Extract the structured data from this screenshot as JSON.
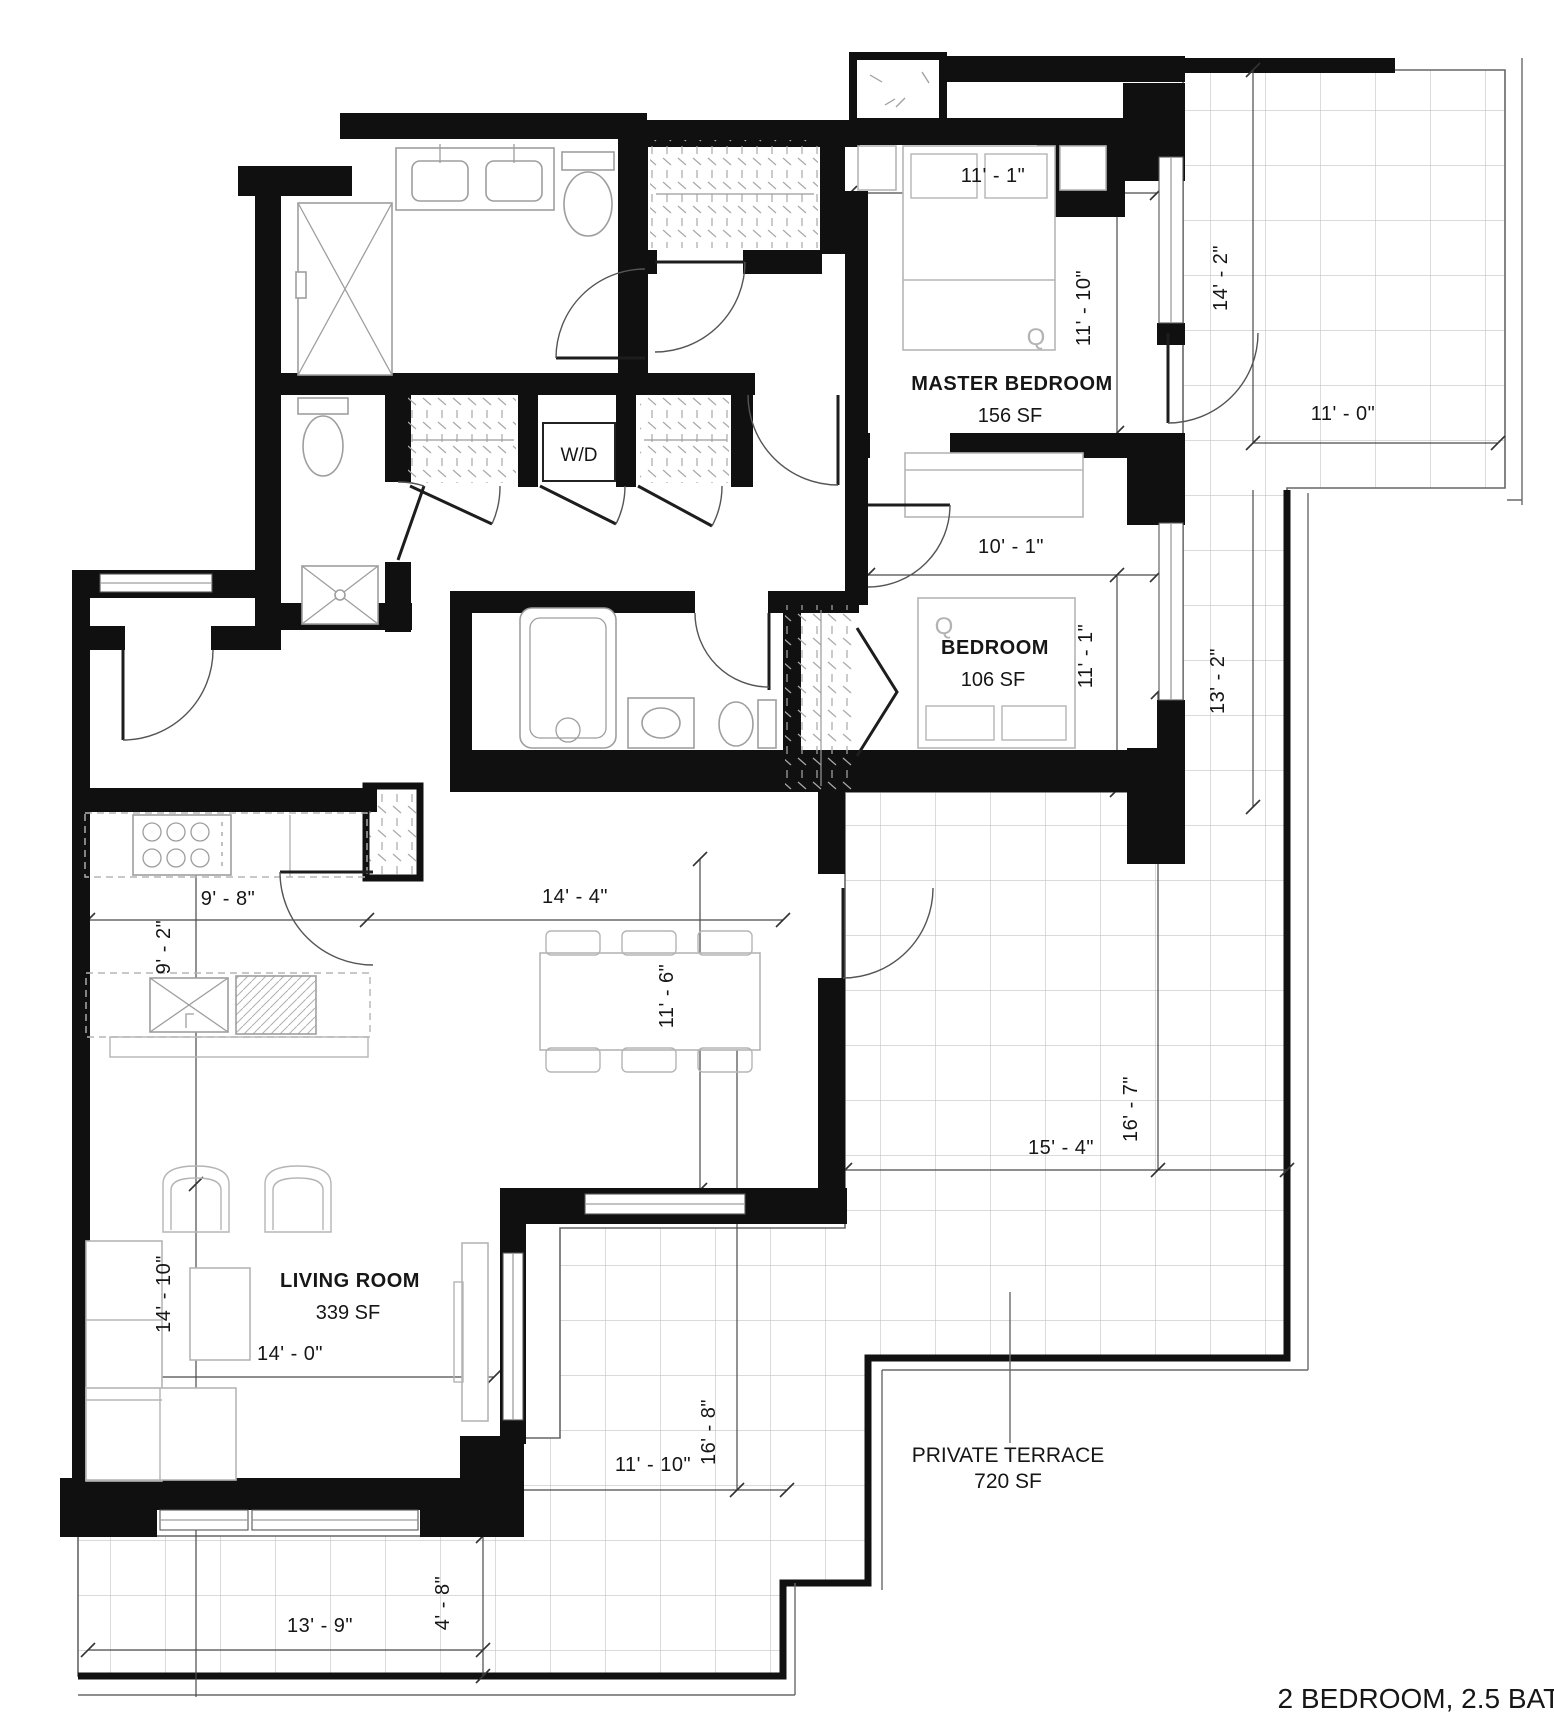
{
  "plan_title": "2 BEDROOM, 2.5 BATH",
  "rooms": {
    "master_bedroom": {
      "label": "MASTER BEDROOM",
      "area": "156 SF",
      "bed_tag": "Q"
    },
    "bedroom": {
      "label": "BEDROOM",
      "area": "106 SF",
      "bed_tag": "Q"
    },
    "living_room": {
      "label": "LIVING ROOM",
      "area": "339 SF"
    },
    "private_terrace": {
      "label": "PRIVATE TERRACE",
      "area": "720 SF"
    },
    "laundry_closet": {
      "label": "W/D"
    }
  },
  "dimensions": {
    "master_bedroom_width": "11' - 1\"",
    "master_bedroom_depth": "11' - 10\"",
    "terrace_north_depth": "14' - 2\"",
    "terrace_north_width": "11' - 0\"",
    "bedroom_width": "10' - 1\"",
    "bedroom_depth": "11' - 1\"",
    "terrace_east_depth": "13' - 2\"",
    "kitchen_width": "9' - 8\"",
    "kitchen_depth": "9' - 2\"",
    "dining_width": "14' - 4\"",
    "dining_depth": "11' - 6\"",
    "terrace_south_width": "15' - 4\"",
    "terrace_south_depth": "16' - 7\"",
    "living_room_width": "14' - 0\"",
    "living_room_depth": "14' - 10\"",
    "terrace_west_width": "11' - 10\"",
    "terrace_west_depth": "16' - 8\"",
    "terrace_bottom_width": "13' - 9\"",
    "terrace_bottom_depth": "4' - 8\""
  }
}
